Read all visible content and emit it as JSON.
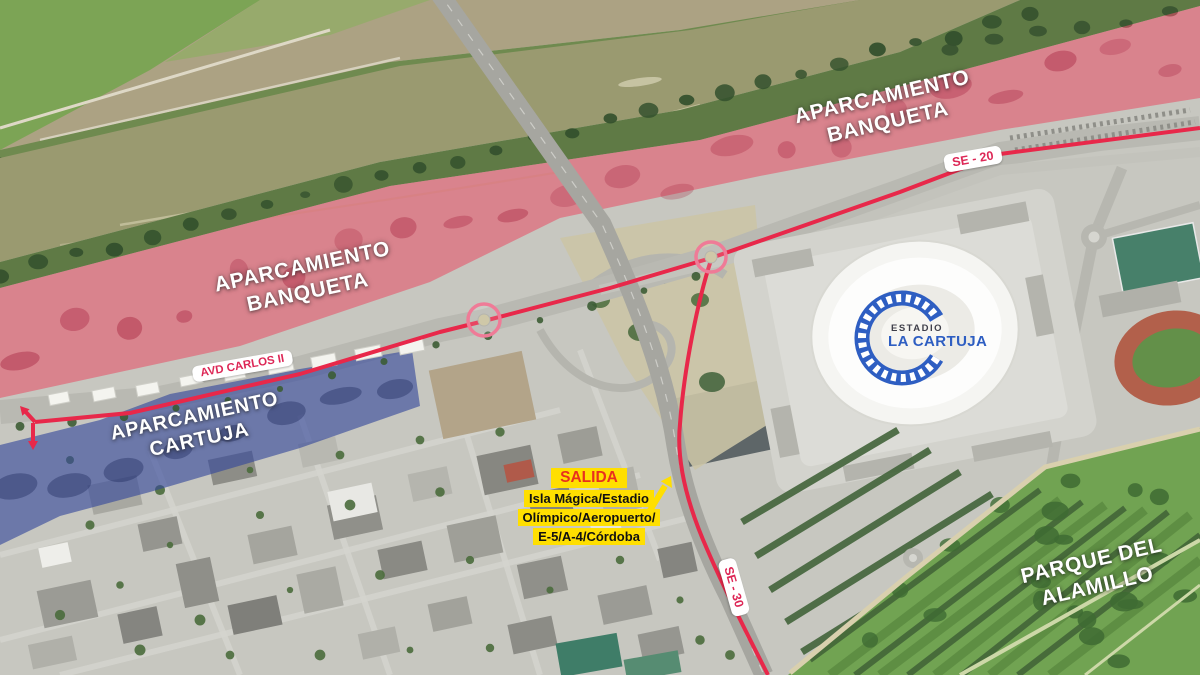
{
  "labels": {
    "banqueta_left": {
      "line1": "APARCAMIENTO",
      "line2": "BANQUETA"
    },
    "banqueta_right": {
      "line1": "APARCAMIENTO",
      "line2": "BANQUETA"
    },
    "cartuja": {
      "line1": "APARCAMIENTO",
      "line2": "CARTUJA"
    },
    "parque": {
      "line1": "PARQUE DEL",
      "line2": "ALAMILLO"
    }
  },
  "road_labels": {
    "se20": "SE - 20",
    "se30": "SE - 30",
    "avd_carlos": "AVD CARLOS II"
  },
  "exit_sign": {
    "title": "SALIDA",
    "line1": "Isla Mágica/Estadio",
    "line2": "Olímpico/Aeropuerto/",
    "line3": "E-5/A-4/Córdoba"
  },
  "stadium": {
    "name_line1": "ESTADIO",
    "name_line2": "LA CARTUJA"
  },
  "colors": {
    "zone_banqueta": "#e84b63",
    "zone_cartuja": "#33479b",
    "zone_text": "#ffffff",
    "route": "#e8284a",
    "roundabout_ring": "#ef7b97",
    "road_label_text": "#dd2756",
    "exit_bg": "#ffdf00",
    "exit_title": "#e8301e",
    "exit_text": "#111111",
    "stadium_blue": "#2e5ec2"
  }
}
